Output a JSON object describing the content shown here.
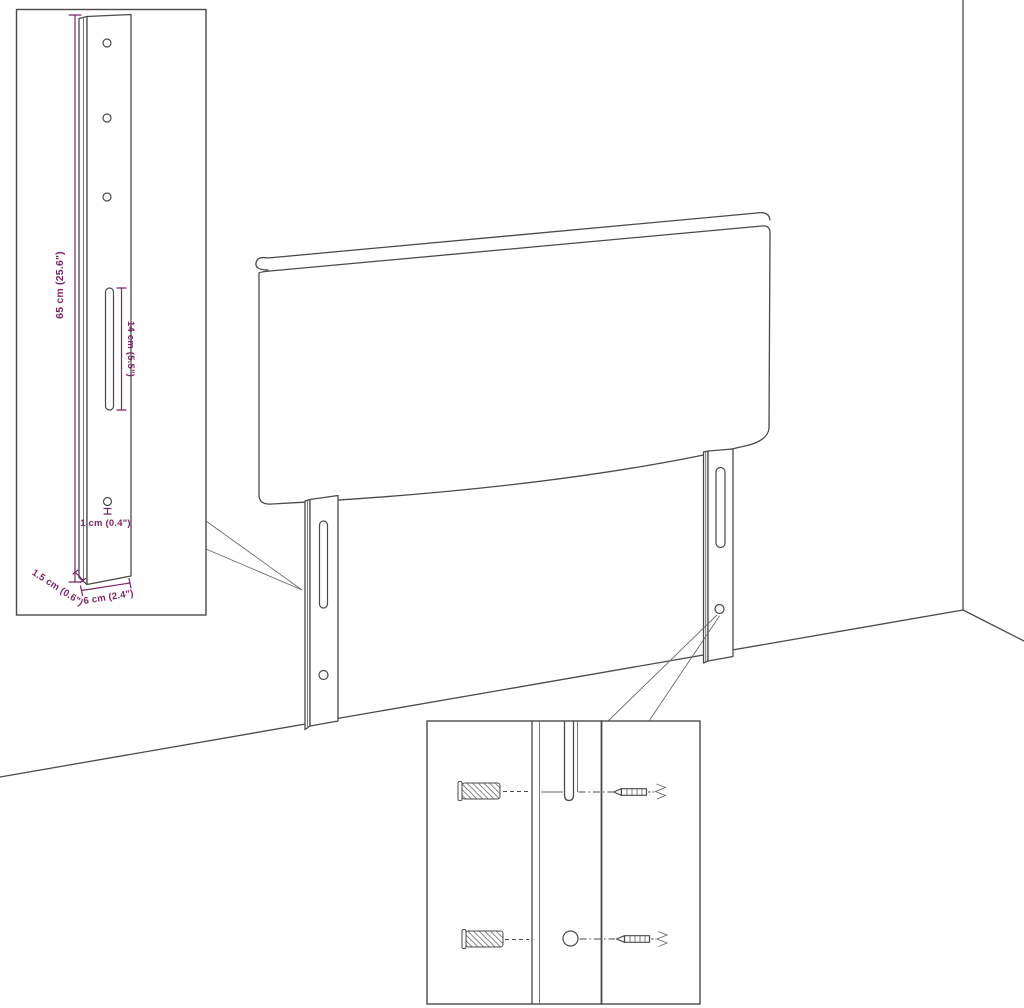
{
  "diagram": {
    "type": "furniture-dimension-diagram",
    "subject": "upholstered headboard with two mounting legs shown against a room corner",
    "background_color": "#ffffff",
    "line_color": "#4a4a4a",
    "dimension_color": "#7b2466",
    "inset_top_left": {
      "description": "close-up of mounting leg with holes and slot",
      "dimensions": {
        "leg_height": "65 cm (25.6\")",
        "slot_length": "14 cm (5.5\")",
        "hole_diameter": "1 cm (0.4\")",
        "leg_depth": "1.5 cm (0.6\")",
        "leg_width": "6 cm (2.4\")"
      }
    },
    "inset_bottom": {
      "description": "close-up of leg slot and hole with wall plugs and screws",
      "components": {
        "wall_plug": "wall-plug",
        "screw": "screw",
        "slot": "mounting-slot",
        "hole": "mounting-hole"
      }
    },
    "components": {
      "headboard": "headboard-panel",
      "left_leg": "mounting-leg-left",
      "right_leg": "mounting-leg-right",
      "room": "room-corner"
    }
  }
}
